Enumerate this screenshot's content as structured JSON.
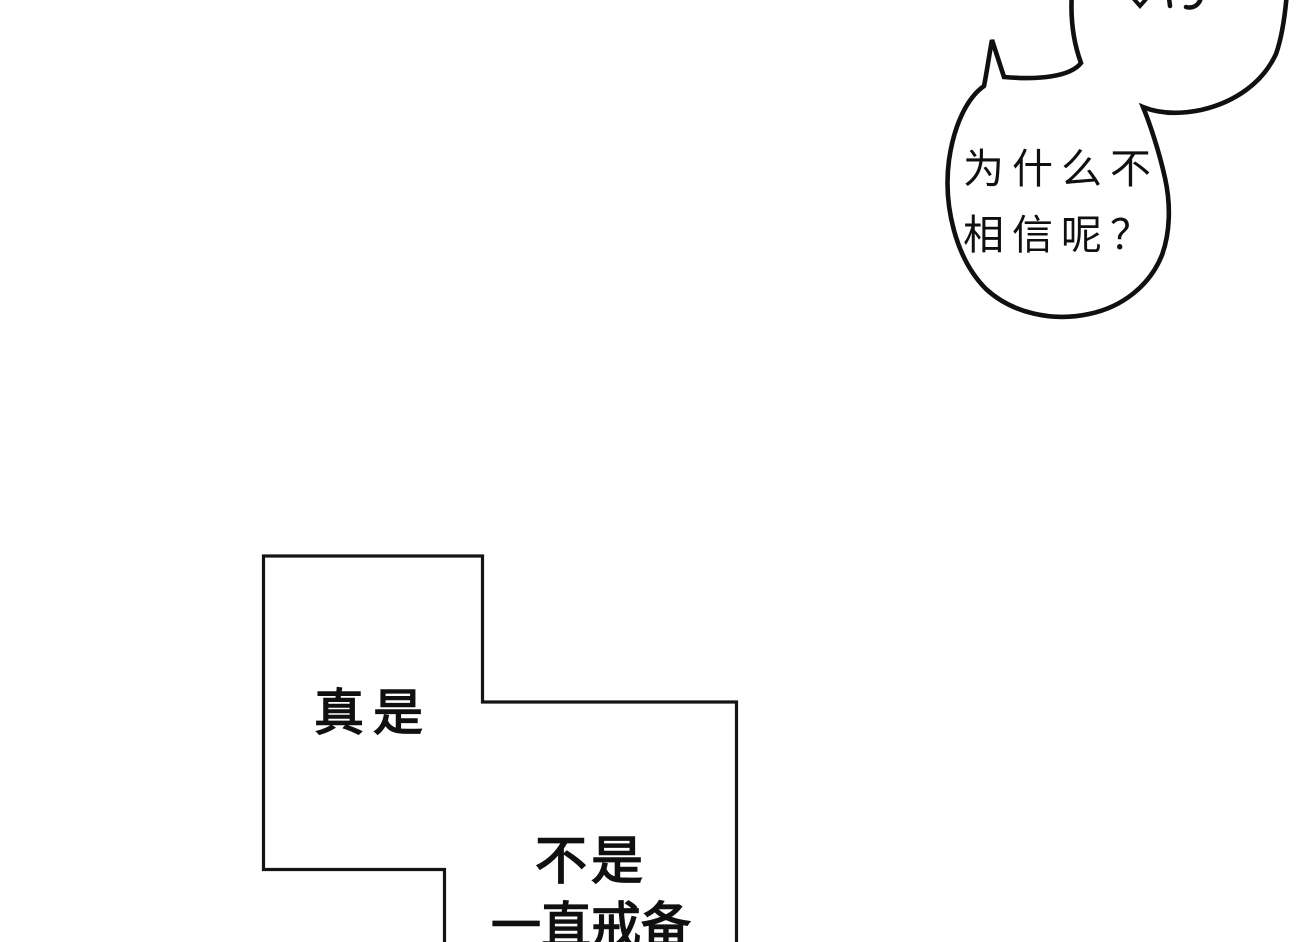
{
  "comic": {
    "colors": {
      "background": "#ffffff",
      "ink": "#101010"
    },
    "bubble": {
      "line1": "为什么不",
      "line2": "相信呢？"
    },
    "panel": {
      "caption1": "真是",
      "caption2": "不是",
      "caption3": "一直戒备"
    }
  }
}
